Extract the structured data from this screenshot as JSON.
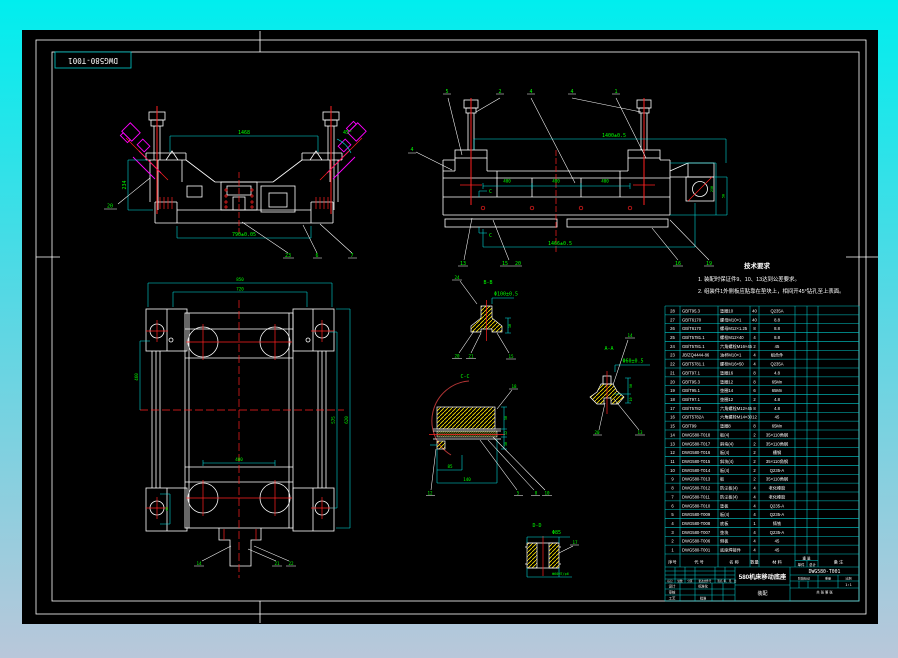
{
  "window": {
    "corner_label": "DWG580-T001"
  },
  "colors": {
    "background_top": "#00eeee",
    "background_bottom": "#b9c7da",
    "canvas": "#000000",
    "line": "#ffffff",
    "dim_line": "#00e5e5",
    "dim_text": "#00ff00",
    "centerline": "#ff2020",
    "bolt": "#ff00ff",
    "hatch": "#ffe600",
    "table_grid": "#00cccc"
  },
  "views": {
    "front": {
      "dim_top": "1468",
      "dim_left": "234",
      "dim_bottom": "790±0.05",
      "angle_label": "45°",
      "leaders": {
        "a": "20",
        "b": "23",
        "c": "6",
        "d": "7"
      }
    },
    "side": {
      "top_labels": [
        "5",
        "2",
        "4",
        "4",
        "1"
      ],
      "left_label": "4",
      "dim_top": "1400±0.5",
      "dim_bottom": "1466±0.5",
      "dim_400": "400",
      "dim_right_a": "250",
      "dim_right_b": "50",
      "section_mark": "C",
      "bottom_labels": [
        "13",
        "15",
        "20",
        "16",
        "19"
      ]
    },
    "plan": {
      "dim_top_a": "850",
      "dim_top_b": "720",
      "dim_left": "460",
      "dim_left_small": "40",
      "dim_right_a": "575",
      "dim_right_b": "620",
      "dim_inner": "400",
      "leaders": [
        "14",
        "21",
        "22"
      ]
    },
    "detail_bb": {
      "title": "B-B",
      "dim_top": "Φ100±0.5",
      "dim_side": "10",
      "leader_top": "24",
      "leaders": [
        "20",
        "21",
        "15"
      ]
    },
    "section_cc": {
      "title": "C-C",
      "dim_right_a": "50",
      "dim_right_b": "12",
      "dim_right_c": "30",
      "dim_bottom_a": "85",
      "dim_bottom_b": "140",
      "leader_top": "18",
      "leader_left": "12",
      "leaders": [
        "5",
        "8",
        "10"
      ]
    },
    "detail_aa": {
      "title": "A-A",
      "dim_top": "Φ60±0.5",
      "dim_right_a": "50",
      "dim_right_b": "10",
      "leader_top": "14",
      "leaders": [
        "20",
        "13"
      ]
    },
    "detail_dd": {
      "title": "D-D",
      "dim_top": "Φ85",
      "dim_bottom": "Φ60H7/p6",
      "leader": "17"
    }
  },
  "tech_notes": {
    "title": "技术要求",
    "items": [
      "1. 装配时保证件9、10、13达到公差要求。",
      "2. 组装件1外侧板应贴靠在垫块上，相间开45°钻孔至上表面。"
    ]
  },
  "bom": {
    "headers": {
      "no": "序号",
      "code": "代  号",
      "name": "名  称",
      "qty": "数量",
      "material": "材  料",
      "weight": "重 量",
      "weight_each": "单件",
      "weight_total": "总计",
      "remark": "备  注"
    },
    "rows": [
      [
        "28",
        "GB/T95.3",
        "垫圈10",
        "40",
        "Q235A"
      ],
      [
        "27",
        "GB/T6170",
        "螺母M10×1",
        "40",
        "8.8"
      ],
      [
        "26",
        "GB/T6170",
        "螺母M12×1.25",
        "8",
        "8.8"
      ],
      [
        "25",
        "GB/T5781.1",
        "螺栓M12×40",
        "4",
        "8.8"
      ],
      [
        "24",
        "GB/T5781.1",
        "六角螺栓M16×45",
        "2",
        "45"
      ],
      [
        "23",
        "JB/ZQ4444-86",
        "油杯M10×1",
        "4",
        "组合件"
      ],
      [
        "22",
        "GB/T5781.1",
        "螺栓M16×50",
        "4",
        "Q235A"
      ],
      [
        "21",
        "GB/T97.1",
        "垫圈16",
        "8",
        "4.8"
      ],
      [
        "20",
        "GB/T95.3",
        "垫圈12",
        "8",
        "65Mn"
      ],
      [
        "19",
        "GB/T95.1",
        "垫圈14",
        "6",
        "65Mn"
      ],
      [
        "18",
        "GB/T97.1",
        "垫圈12",
        "2",
        "4.8"
      ],
      [
        "17",
        "GB/T5782",
        "六角螺栓M12×45",
        "8",
        "4.8"
      ],
      [
        "16",
        "GB/T5782A",
        "六角螺栓M14×30",
        "12",
        "45"
      ],
      [
        "15",
        "GB/T99",
        "垫圈8",
        "8",
        "65Mn"
      ],
      [
        "14",
        "DWG580-T018",
        "板(4)",
        "2",
        "35×110角钢"
      ],
      [
        "13",
        "DWG580-T017",
        "斜块(4)",
        "2",
        "35×110角钢"
      ],
      [
        "12",
        "DWG580-T016",
        "板(4)",
        "2",
        "槽钢"
      ],
      [
        "11",
        "DWG580-T015",
        "斜块(4)",
        "2",
        "35×110角钢"
      ],
      [
        "10",
        "DWG580-T014",
        "板(4)",
        "2",
        "Q235-A"
      ],
      [
        "9",
        "DWG580-T013",
        "板",
        "2",
        "35×110角钢"
      ],
      [
        "8",
        "DWG580-T012",
        "防尘板(4)",
        "4",
        "老化橡胶"
      ],
      [
        "7",
        "DWG580-T011",
        "防尘板(4)",
        "4",
        "老化橡胶"
      ],
      [
        "6",
        "DWG580-T010",
        "垫板",
        "4",
        "Q235-A"
      ],
      [
        "5",
        "DWG580-T009",
        "板(4)",
        "4",
        "Q235-A"
      ],
      [
        "4",
        "DWG580-T008",
        "底板",
        "1",
        "铸铁"
      ],
      [
        "3",
        "DWG580-T007",
        "垫块",
        "4",
        "Q235-A"
      ],
      [
        "2",
        "DWG580-T006",
        "侧板",
        "4",
        "45"
      ],
      [
        "1",
        "DWG580-T001",
        "底座焊接件",
        "4",
        "45"
      ]
    ]
  },
  "title_block": {
    "title": "580机床移动底座",
    "subtitle": "装配",
    "drawing_no": "DWG580-T001",
    "rev_labels": [
      "标记",
      "处数",
      "分区",
      "更改文件号",
      "签名",
      "年、月、日"
    ],
    "sign_labels": [
      "设计",
      "审核",
      "工艺"
    ],
    "sign_labels2": [
      "标准化",
      "批准"
    ],
    "stage_label": "阶段标记",
    "weight_label": "重量",
    "scale_label": "比例",
    "scale_value": "1:1",
    "sheet_info": "共 张  第 张"
  }
}
